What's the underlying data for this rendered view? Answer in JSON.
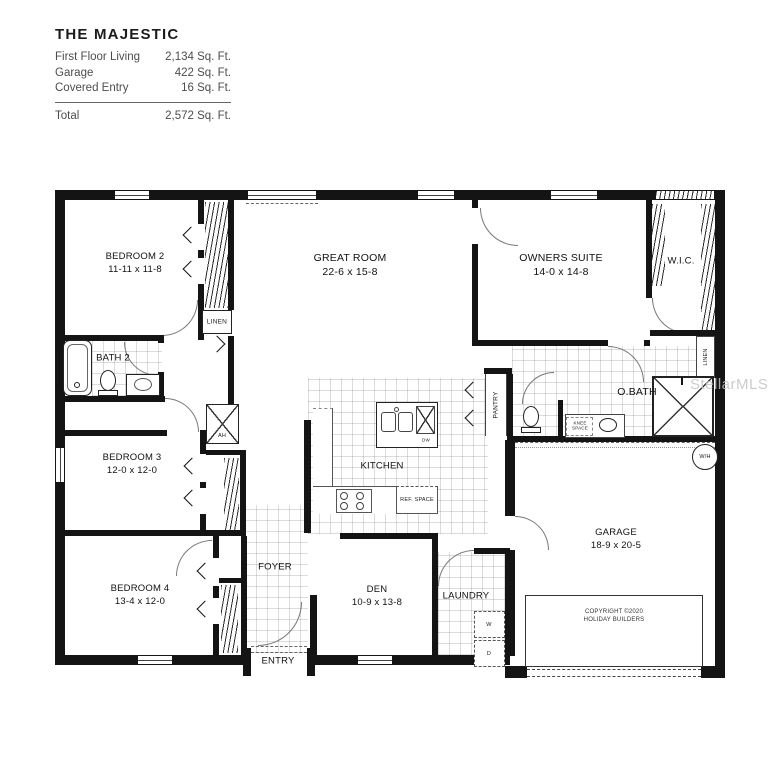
{
  "title_block": {
    "title": "THE MAJESTIC",
    "rows": [
      {
        "label": "First Floor Living",
        "value": "2,134 Sq. Ft."
      },
      {
        "label": "Garage",
        "value": "422 Sq. Ft."
      },
      {
        "label": "Covered Entry",
        "value": "16 Sq. Ft."
      }
    ],
    "total_label": "Total",
    "total_value": "2,572 Sq. Ft."
  },
  "rooms": {
    "bedroom2": {
      "name": "BEDROOM 2",
      "dims": "11-11 x 11-8"
    },
    "great_room": {
      "name": "GREAT ROOM",
      "dims": "22-6 x 15-8"
    },
    "owners_suite": {
      "name": "OWNERS SUITE",
      "dims": "14-0 x 14-8"
    },
    "wic": {
      "name": "W.I.C."
    },
    "bath2": {
      "name": "BATH 2"
    },
    "bedroom3": {
      "name": "BEDROOM 3",
      "dims": "12-0 x 12-0"
    },
    "kitchen": {
      "name": "KITCHEN"
    },
    "obath": {
      "name": "O.BATH"
    },
    "bedroom4": {
      "name": "BEDROOM 4",
      "dims": "13-4 x 12-0"
    },
    "foyer": {
      "name": "FOYER"
    },
    "den": {
      "name": "DEN",
      "dims": "10-9 x 13-8"
    },
    "laundry": {
      "name": "LAUNDRY"
    },
    "entry": {
      "name": "ENTRY"
    },
    "garage": {
      "name": "GARAGE",
      "dims": "18-9 x 20-5"
    }
  },
  "labels": {
    "linen_top": "LINEN",
    "linen_right": "LINEN",
    "pantry": "PANTRY",
    "knee_space": "KNEE SPACE",
    "ref_space": "REF. SPACE",
    "ah": "AH",
    "wh": "W/H",
    "dw": "DW",
    "washer": "W",
    "dryer": "D"
  },
  "copyright": {
    "line1": "COPYRIGHT ©2020",
    "line2": "HOLIDAY BUILDERS"
  },
  "watermark": "StellarMLS"
}
